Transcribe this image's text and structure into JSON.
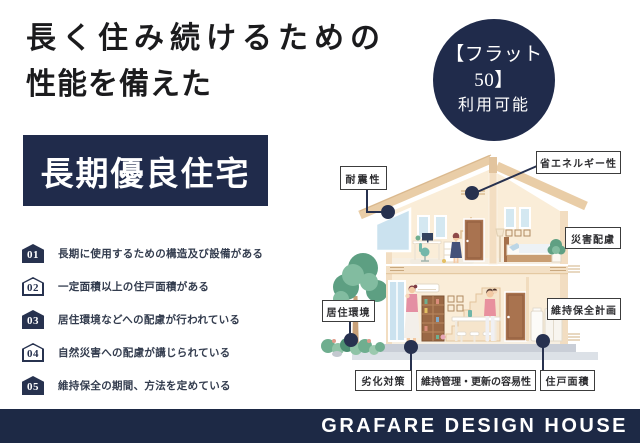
{
  "page": {
    "title": {
      "line1": "長く住み続けるための",
      "line2": "性能を備えた"
    },
    "flat50_badge": {
      "line1": "【フラット50】",
      "line2": "利用可能"
    },
    "banner": {
      "label": "長期優良住宅"
    },
    "features": [
      {
        "num": "01",
        "text": "長期に使用するための構造及び設備がある"
      },
      {
        "num": "02",
        "text": "一定面積以上の住戸面積がある"
      },
      {
        "num": "03",
        "text": "居住環境などへの配慮が行われている"
      },
      {
        "num": "04",
        "text": "自然災害への配慮が講じられている"
      },
      {
        "num": "05",
        "text": "維持保全の期間、方法を定めている"
      }
    ],
    "house_labels": {
      "taishin": "耐震性",
      "shoene": "省エネルギー性",
      "saigai": "災害配慮",
      "kyoju": "居住環境",
      "ijihozen": "維持保全計画",
      "rekka": "劣化対策",
      "ijikanri": "維持管理・更新の容易性",
      "juko": "住戸面積"
    },
    "footer": {
      "brand": "GRAFARE DESIGN HOUSE"
    },
    "colors": {
      "navy": "#202b4b",
      "footer_navy": "#1d2945",
      "connector": "#27314f",
      "roof_tan": "#e9cda7",
      "wall_cream": "#faedd8"
    }
  }
}
